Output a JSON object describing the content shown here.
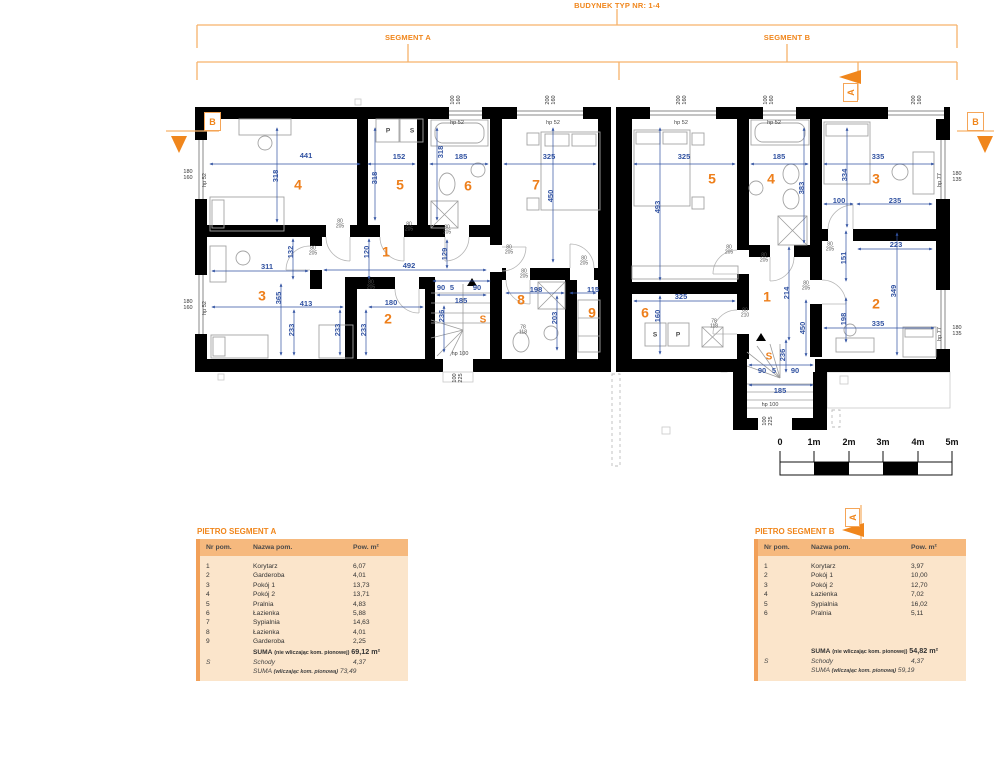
{
  "header": {
    "title": "BUDYNEK TYP NR: 1-4",
    "segment_a": "SEGMENT A",
    "segment_b": "SEGMENT B"
  },
  "section_markers": {
    "a": "A",
    "b": "B"
  },
  "scale_bar": {
    "ticks": [
      {
        "t": "0",
        "x": 780,
        "y": 443,
        "c": "scale"
      },
      {
        "t": "1m",
        "x": 814,
        "y": 443,
        "c": "scale"
      },
      {
        "t": "2m",
        "x": 849,
        "y": 443,
        "c": "scale"
      },
      {
        "t": "3m",
        "x": 883,
        "y": 443,
        "c": "scale"
      },
      {
        "t": "4m",
        "x": 918,
        "y": 443,
        "c": "scale"
      },
      {
        "t": "5m",
        "x": 952,
        "y": 443,
        "c": "scale"
      }
    ]
  },
  "plan": {
    "labels": [
      {
        "t": "4",
        "x": 298,
        "y": 185,
        "c": "num"
      },
      {
        "t": "5",
        "x": 400,
        "y": 185,
        "c": "num"
      },
      {
        "t": "6",
        "x": 468,
        "y": 186,
        "c": "num"
      },
      {
        "t": "7",
        "x": 536,
        "y": 185,
        "c": "num"
      },
      {
        "t": "1",
        "x": 386,
        "y": 252,
        "c": "num"
      },
      {
        "t": "3",
        "x": 262,
        "y": 296,
        "c": "num"
      },
      {
        "t": "2",
        "x": 388,
        "y": 319,
        "c": "num"
      },
      {
        "t": "8",
        "x": 521,
        "y": 300,
        "c": "num"
      },
      {
        "t": "9",
        "x": 592,
        "y": 313,
        "c": "num"
      },
      {
        "t": "S",
        "x": 483,
        "y": 321,
        "c": "snum"
      },
      {
        "t": "5",
        "x": 712,
        "y": 179,
        "c": "num"
      },
      {
        "t": "4",
        "x": 771,
        "y": 179,
        "c": "num"
      },
      {
        "t": "3",
        "x": 876,
        "y": 179,
        "c": "num"
      },
      {
        "t": "1",
        "x": 767,
        "y": 297,
        "c": "num"
      },
      {
        "t": "6",
        "x": 645,
        "y": 313,
        "c": "num"
      },
      {
        "t": "2",
        "x": 876,
        "y": 304,
        "c": "num"
      },
      {
        "t": "S",
        "x": 769,
        "y": 358,
        "c": "snum"
      },
      {
        "t": "441",
        "x": 306,
        "y": 156,
        "c": "dim"
      },
      {
        "t": "152",
        "x": 399,
        "y": 157,
        "c": "dim"
      },
      {
        "t": "185",
        "x": 461,
        "y": 157,
        "c": "dim"
      },
      {
        "t": "325",
        "x": 549,
        "y": 157,
        "c": "dim"
      },
      {
        "t": "318",
        "x": 276,
        "y": 176,
        "r": -90,
        "c": "dim"
      },
      {
        "t": "318",
        "x": 375,
        "y": 178,
        "r": -90,
        "c": "dim"
      },
      {
        "t": "318",
        "x": 441,
        "y": 152,
        "r": -90,
        "c": "dim"
      },
      {
        "t": "450",
        "x": 551,
        "y": 196,
        "r": -90,
        "c": "dim"
      },
      {
        "t": "311",
        "x": 267,
        "y": 267,
        "c": "dim"
      },
      {
        "t": "132",
        "x": 291,
        "y": 252,
        "r": -90,
        "c": "dim"
      },
      {
        "t": "120",
        "x": 367,
        "y": 252,
        "r": -90,
        "c": "dim"
      },
      {
        "t": "492",
        "x": 409,
        "y": 266,
        "c": "dim"
      },
      {
        "t": "365",
        "x": 279,
        "y": 298,
        "r": -90,
        "c": "dim"
      },
      {
        "t": "413",
        "x": 306,
        "y": 304,
        "c": "dim"
      },
      {
        "t": "233",
        "x": 292,
        "y": 330,
        "r": -90,
        "c": "dim"
      },
      {
        "t": "233",
        "x": 338,
        "y": 330,
        "r": -90,
        "c": "dim"
      },
      {
        "t": "233",
        "x": 364,
        "y": 330,
        "r": -90,
        "c": "dim"
      },
      {
        "t": "180",
        "x": 391,
        "y": 303,
        "c": "dim"
      },
      {
        "t": "129",
        "x": 445,
        "y": 254,
        "r": -90,
        "c": "dim"
      },
      {
        "t": "90",
        "x": 441,
        "y": 288,
        "c": "dim"
      },
      {
        "t": "5",
        "x": 452,
        "y": 288,
        "c": "dim"
      },
      {
        "t": "90",
        "x": 477,
        "y": 288,
        "c": "dim"
      },
      {
        "t": "185",
        "x": 461,
        "y": 301,
        "c": "dim"
      },
      {
        "t": "236",
        "x": 442,
        "y": 316,
        "r": -90,
        "c": "dim"
      },
      {
        "t": "198",
        "x": 536,
        "y": 290,
        "c": "dim"
      },
      {
        "t": "203",
        "x": 555,
        "y": 318,
        "r": -90,
        "c": "dim"
      },
      {
        "t": "115",
        "x": 593,
        "y": 290,
        "c": "dim"
      },
      {
        "t": "325",
        "x": 684,
        "y": 157,
        "c": "dim"
      },
      {
        "t": "185",
        "x": 779,
        "y": 157,
        "c": "dim"
      },
      {
        "t": "335",
        "x": 878,
        "y": 157,
        "c": "dim"
      },
      {
        "t": "493",
        "x": 658,
        "y": 207,
        "r": -90,
        "c": "dim"
      },
      {
        "t": "383",
        "x": 802,
        "y": 188,
        "r": -90,
        "c": "dim"
      },
      {
        "t": "334",
        "x": 845,
        "y": 175,
        "r": -90,
        "c": "dim"
      },
      {
        "t": "100",
        "x": 839,
        "y": 201,
        "c": "dim"
      },
      {
        "t": "235",
        "x": 895,
        "y": 201,
        "c": "dim"
      },
      {
        "t": "223",
        "x": 896,
        "y": 245,
        "c": "dim"
      },
      {
        "t": "151",
        "x": 844,
        "y": 258,
        "r": -90,
        "c": "dim"
      },
      {
        "t": "214",
        "x": 787,
        "y": 293,
        "r": -90,
        "c": "dim"
      },
      {
        "t": "450",
        "x": 803,
        "y": 328,
        "r": -90,
        "c": "dim"
      },
      {
        "t": "325",
        "x": 681,
        "y": 297,
        "c": "dim"
      },
      {
        "t": "160",
        "x": 658,
        "y": 316,
        "r": -90,
        "c": "dim"
      },
      {
        "t": "349",
        "x": 894,
        "y": 291,
        "r": -90,
        "c": "dim"
      },
      {
        "t": "335",
        "x": 878,
        "y": 324,
        "c": "dim"
      },
      {
        "t": "198",
        "x": 844,
        "y": 319,
        "r": -90,
        "c": "dim"
      },
      {
        "t": "236",
        "x": 783,
        "y": 355,
        "r": -90,
        "c": "dim"
      },
      {
        "t": "90",
        "x": 762,
        "y": 371,
        "c": "dim"
      },
      {
        "t": "5",
        "x": 774,
        "y": 371,
        "c": "dim"
      },
      {
        "t": "90",
        "x": 795,
        "y": 371,
        "c": "dim"
      },
      {
        "t": "185",
        "x": 780,
        "y": 391,
        "c": "dim"
      },
      {
        "t": "80\n205",
        "x": 313,
        "y": 252,
        "c": "door"
      },
      {
        "t": "80\n205",
        "x": 340,
        "y": 225,
        "c": "door"
      },
      {
        "t": "80\n205",
        "x": 409,
        "y": 228,
        "c": "door"
      },
      {
        "t": "80\n205",
        "x": 447,
        "y": 231,
        "c": "door"
      },
      {
        "t": "80\n205",
        "x": 509,
        "y": 251,
        "c": "door"
      },
      {
        "t": "80\n205",
        "x": 524,
        "y": 275,
        "c": "door"
      },
      {
        "t": "80\n205",
        "x": 584,
        "y": 262,
        "c": "door"
      },
      {
        "t": "80\n205",
        "x": 371,
        "y": 286,
        "c": "door"
      },
      {
        "t": "80\n205",
        "x": 729,
        "y": 251,
        "c": "door"
      },
      {
        "t": "80\n205",
        "x": 764,
        "y": 259,
        "c": "door"
      },
      {
        "t": "80\n205",
        "x": 806,
        "y": 287,
        "c": "door"
      },
      {
        "t": "80\n205",
        "x": 830,
        "y": 248,
        "c": "door"
      },
      {
        "t": "80\n210",
        "x": 745,
        "y": 314,
        "c": "door"
      },
      {
        "t": "78\n118",
        "x": 523,
        "y": 331,
        "c": "door"
      },
      {
        "t": "78\n118",
        "x": 714,
        "y": 325,
        "c": "door"
      },
      {
        "t": "hp 52",
        "x": 457,
        "y": 124,
        "c": "hp"
      },
      {
        "t": "hp 52",
        "x": 553,
        "y": 124,
        "c": "hp"
      },
      {
        "t": "hp 52",
        "x": 681,
        "y": 124,
        "c": "hp"
      },
      {
        "t": "hp 52",
        "x": 774,
        "y": 124,
        "c": "hp"
      },
      {
        "t": "hp 100",
        "x": 460,
        "y": 355,
        "c": "hp"
      },
      {
        "t": "hp 100",
        "x": 770,
        "y": 406,
        "c": "hp"
      },
      {
        "t": "hp 52",
        "x": 206,
        "y": 180,
        "r": -90,
        "c": "hp"
      },
      {
        "t": "hp 52",
        "x": 206,
        "y": 308,
        "r": -90,
        "c": "hp"
      },
      {
        "t": "hp 77",
        "x": 941,
        "y": 180,
        "r": -90,
        "c": "hp"
      },
      {
        "t": "hp 77",
        "x": 941,
        "y": 334,
        "r": -90,
        "c": "hp"
      },
      {
        "t": "180\n160",
        "x": 188,
        "y": 176,
        "c": "win"
      },
      {
        "t": "180\n160",
        "x": 188,
        "y": 306,
        "c": "win"
      },
      {
        "t": "180\n135",
        "x": 957,
        "y": 178,
        "c": "win"
      },
      {
        "t": "180\n135",
        "x": 957,
        "y": 332,
        "c": "win"
      },
      {
        "t": "100\n160",
        "x": 457,
        "y": 100,
        "r": -90,
        "c": "win"
      },
      {
        "t": "200\n160",
        "x": 552,
        "y": 100,
        "r": -90,
        "c": "win"
      },
      {
        "t": "200\n160",
        "x": 683,
        "y": 100,
        "r": -90,
        "c": "win"
      },
      {
        "t": "100\n160",
        "x": 770,
        "y": 100,
        "r": -90,
        "c": "win"
      },
      {
        "t": "200\n160",
        "x": 918,
        "y": 100,
        "r": -90,
        "c": "win"
      },
      {
        "t": "100\n225",
        "x": 459,
        "y": 378,
        "r": -90,
        "c": "win"
      },
      {
        "t": "100\n225",
        "x": 769,
        "y": 421,
        "r": -90,
        "c": "win"
      },
      {
        "t": "P",
        "x": 388,
        "y": 131,
        "c": "app"
      },
      {
        "t": "S",
        "x": 412,
        "y": 131,
        "c": "app"
      },
      {
        "t": "S",
        "x": 655,
        "y": 335,
        "c": "app"
      },
      {
        "t": "P",
        "x": 678,
        "y": 335,
        "c": "app"
      }
    ]
  },
  "tables": {
    "a": {
      "title": "PIETRO SEGMENT A",
      "columns": [
        "Nr pom.",
        "Nazwa pom.",
        "Pow. m²"
      ],
      "rows": [
        {
          "nr": "1",
          "name": "Korytarz",
          "area": "6,07"
        },
        {
          "nr": "2",
          "name": "Garderoba",
          "area": "4,01"
        },
        {
          "nr": "3",
          "name": "Pokój 1",
          "area": "13,73"
        },
        {
          "nr": "4",
          "name": "Pokój 2",
          "area": "13,71"
        },
        {
          "nr": "5",
          "name": "Pralnia",
          "area": "4,83"
        },
        {
          "nr": "6",
          "name": "Łazienka",
          "area": "5,88"
        },
        {
          "nr": "7",
          "name": "Sypialnia",
          "area": "14,63"
        },
        {
          "nr": "8",
          "name": "Łazienka",
          "area": "4,01"
        },
        {
          "nr": "9",
          "name": "Garderoba",
          "area": "2,25"
        }
      ],
      "suma1_label": "SUMA",
      "suma1_note": "(nie wliczając kom. pionowej)",
      "suma1_value": "69,12 m²",
      "schody_nr": "S",
      "schody_name": "Schody",
      "schody_value": "4,37",
      "suma2_label": "SUMA",
      "suma2_note": "(wliczając kom. pionową)",
      "suma2_value": "73,49"
    },
    "b": {
      "title": "PIETRO SEGMENT B",
      "columns": [
        "Nr pom.",
        "Nazwa pom.",
        "Pow. m²"
      ],
      "rows": [
        {
          "nr": "1",
          "name": "Korytarz",
          "area": "3,97"
        },
        {
          "nr": "2",
          "name": "Pokój 1",
          "area": "10,00"
        },
        {
          "nr": "3",
          "name": "Pokój 2",
          "area": "12,70"
        },
        {
          "nr": "4",
          "name": "Łazienka",
          "area": "7,02"
        },
        {
          "nr": "5",
          "name": "Sypialnia",
          "area": "16,02"
        },
        {
          "nr": "6",
          "name": "Pralnia",
          "area": "5,11"
        }
      ],
      "suma1_label": "SUMA",
      "suma1_note": "(nie wliczając kom. pionowej)",
      "suma1_value": "54,82 m²",
      "schody_nr": "S",
      "schody_name": "Schody",
      "schody_value": "4,37",
      "suma2_label": "SUMA",
      "suma2_note": "(wliczając kom. pionową)",
      "suma2_value": "59,19"
    }
  }
}
